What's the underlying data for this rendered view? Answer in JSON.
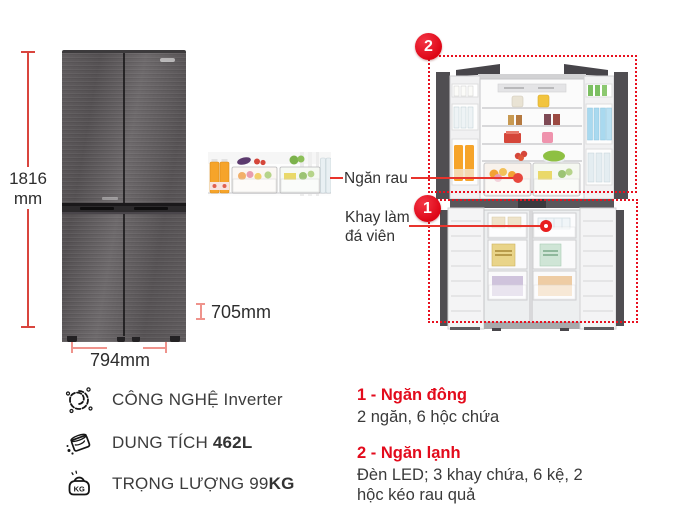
{
  "colors": {
    "accent_red": "#e8101f",
    "measure_red": "#d9453e",
    "measure_red_light": "#ef938c",
    "text_dark": "#2e2e2e"
  },
  "dimensions": {
    "height_value": "1816",
    "height_unit": "mm",
    "depth": "705mm",
    "width": "794mm"
  },
  "callouts": {
    "vegetable_drawer": "Ngăn rau",
    "ice_tray_line1": "Khay làm",
    "ice_tray_line2": "đá viên",
    "freezer_badge": "1",
    "fridge_badge": "2"
  },
  "features": [
    {
      "icon": "inverter-chip-icon",
      "text": "CÔNG NGHỆ Inverter",
      "bold": ""
    },
    {
      "icon": "capacity-jug-icon",
      "text": "DUNG TÍCH ",
      "bold": "462L"
    },
    {
      "icon": "weight-kg-icon",
      "text": "TRỌNG LƯỢNG 99",
      "bold": "KG"
    }
  ],
  "weight_icon_label": "KG",
  "legend": [
    {
      "title": "1 - Ngăn đông",
      "desc": "2 ngăn, 6 hộc chứa"
    },
    {
      "title": "2 - Ngăn lạnh",
      "desc": "Đèn LED; 3 khay chứa, 6 kệ, 2 hộc kéo rau quả"
    }
  ]
}
